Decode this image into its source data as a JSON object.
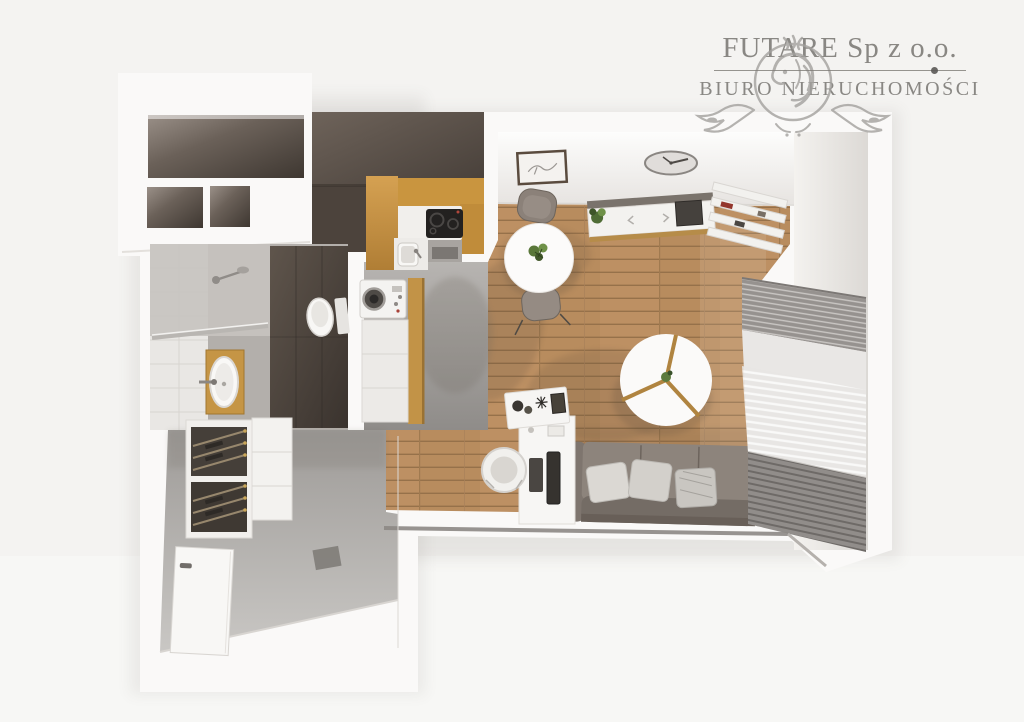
{
  "watermark": {
    "company": "FUTARE Sp z o.o.",
    "tagline": "BIURO NIERUCHOMOŚCI",
    "emblem": "lion-crest",
    "text_color": "#87847f"
  },
  "palette": {
    "background": "#f4f3f1",
    "walls": "#faf9f8",
    "dark_feature_wall": "#4c433c",
    "wood_floor": "#b88c5e",
    "kitchen_cabinet_oak": "#c9953f",
    "concrete_floor": "#a9a6a3",
    "sofa_gray": "#8d847c",
    "accent_red": "#93362c"
  },
  "floorplan": {
    "view": "top-down-3d-apartment-render",
    "rooms": [
      "entry-closet",
      "bathroom",
      "kitchen",
      "hallway",
      "living-room"
    ],
    "furniture": [
      "wardrobe-shelves",
      "shower",
      "toilet",
      "washing-machine",
      "bathroom-vanity",
      "kitchen-cooktop",
      "kitchen-sink",
      "shoe-rack",
      "entry-door",
      "dining-table",
      "dining-chairs",
      "sideboard",
      "wall-clock",
      "picture-frame",
      "corner-shelf",
      "coffee-table",
      "sofa",
      "desk",
      "desk-chair",
      "side-table",
      "radiator",
      "window-blinds"
    ]
  }
}
